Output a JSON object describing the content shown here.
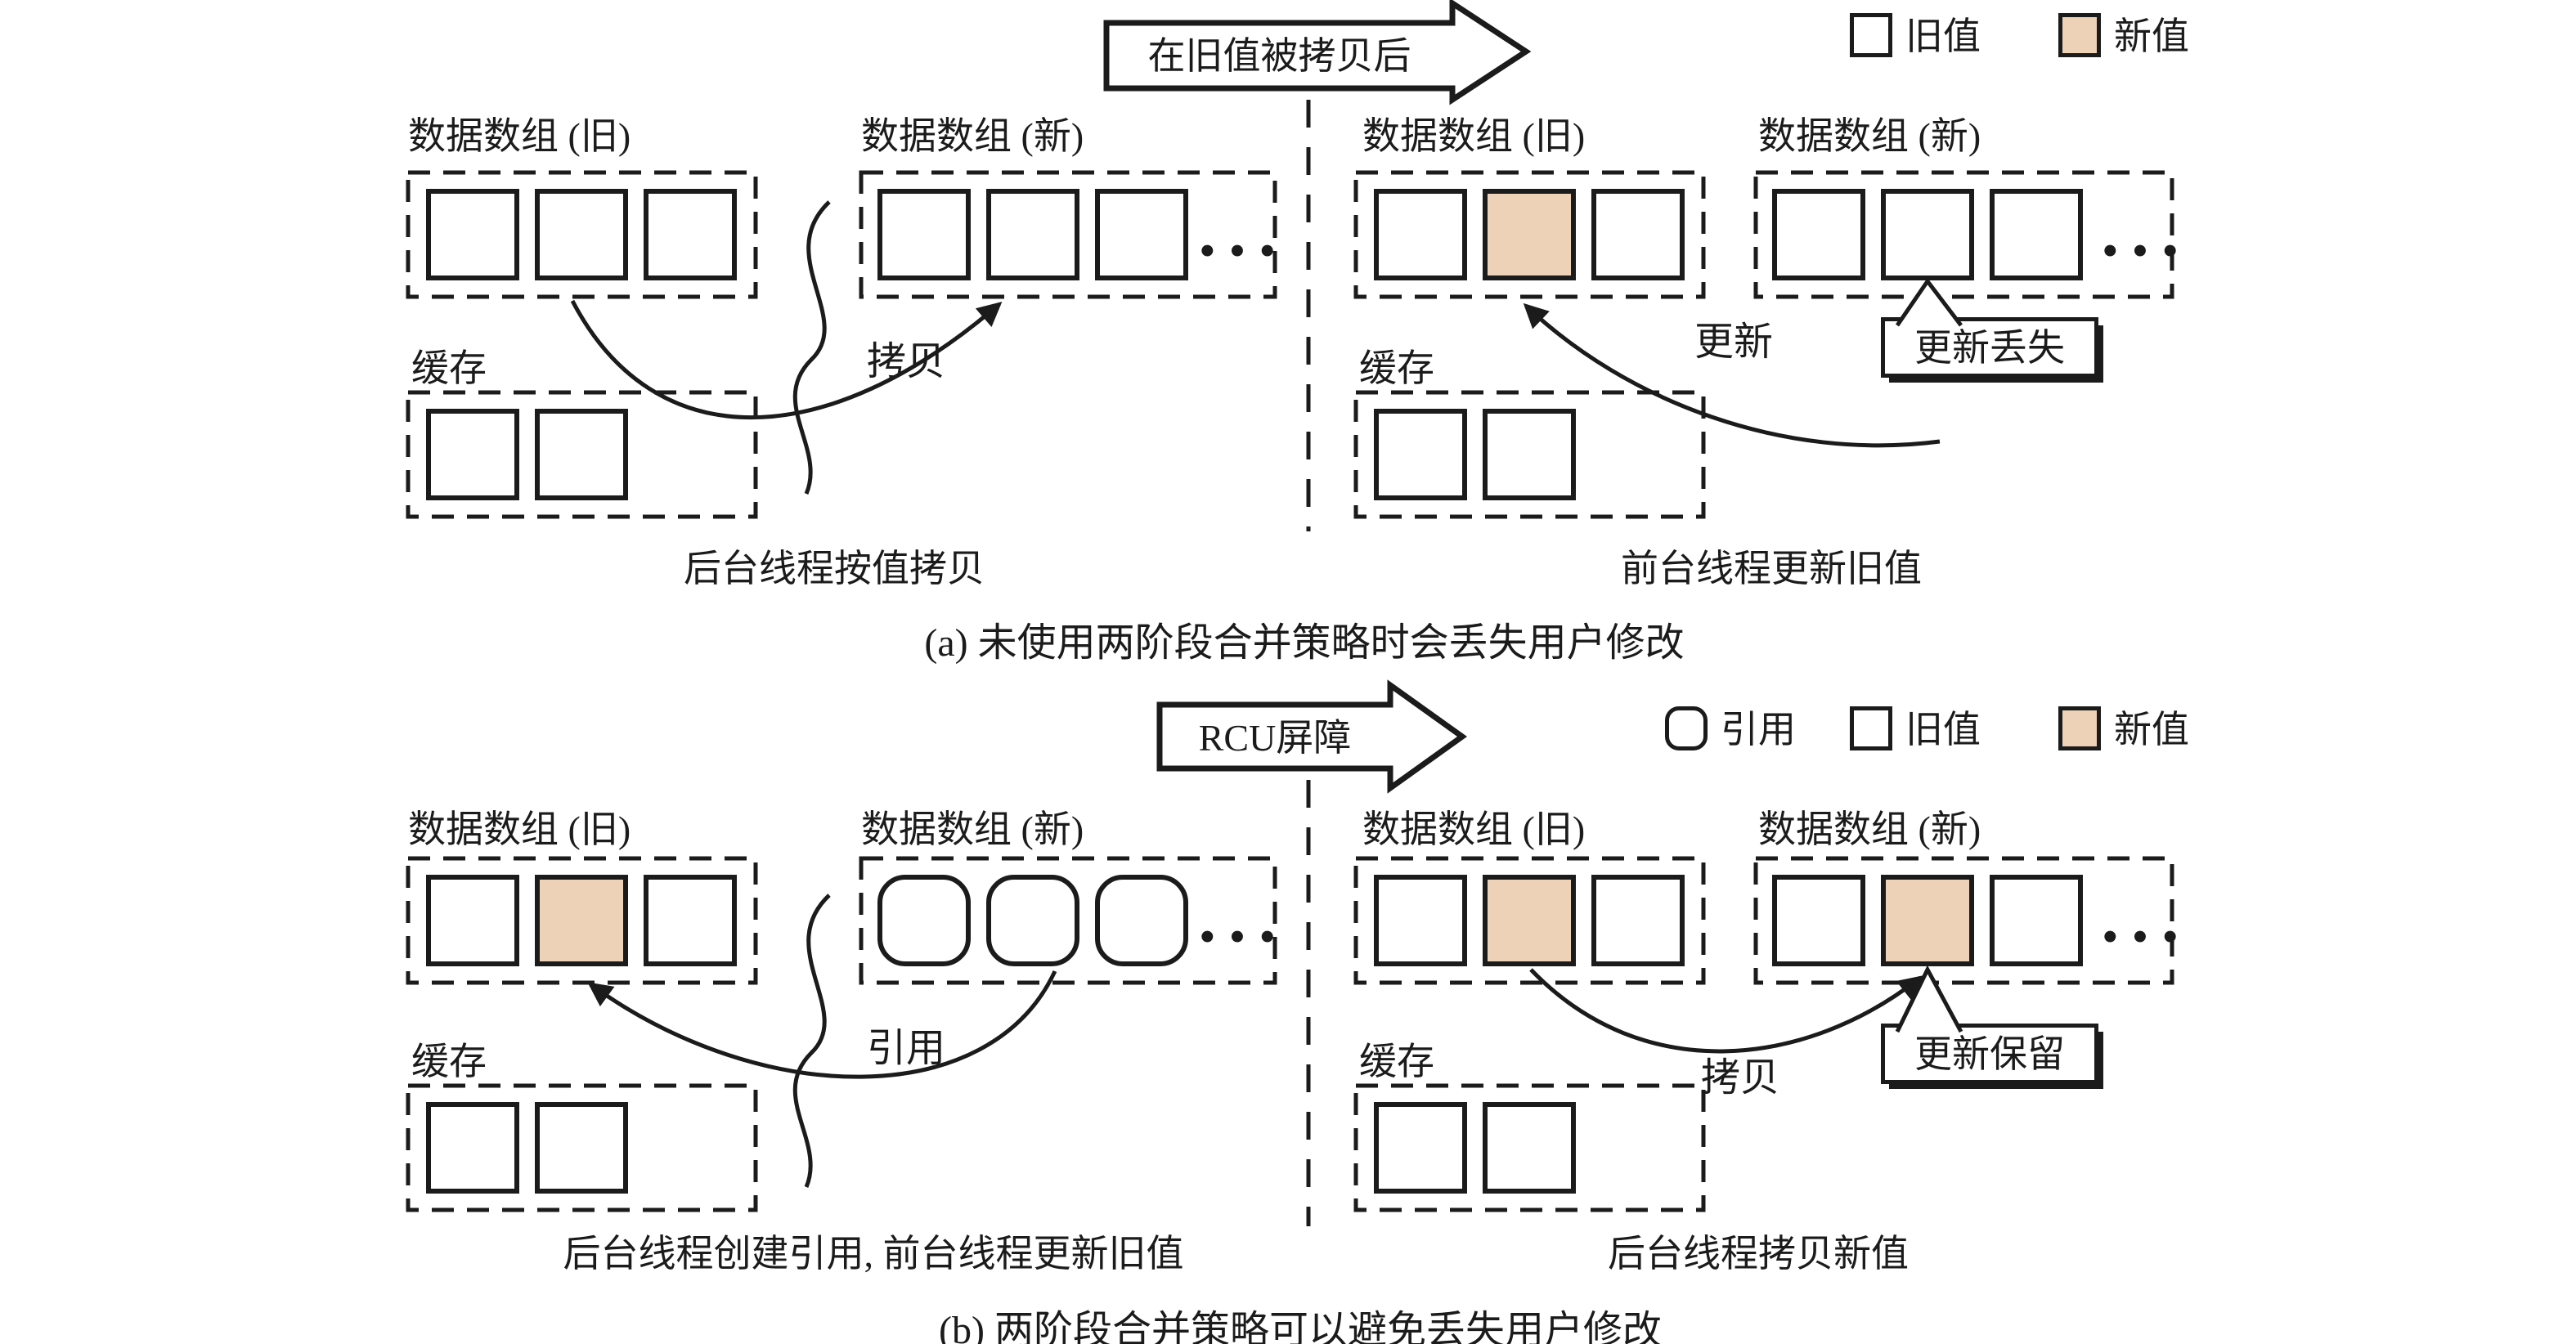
{
  "figure": {
    "accent_color": "#EED2B7",
    "ink_color": "#1b1b1b",
    "ellipsis": "···",
    "a": {
      "stage_arrow": "在旧值被拷贝后",
      "legend": {
        "old": "旧值",
        "new": "新值"
      },
      "left": {
        "old_title": "数据数组 (旧)",
        "new_title": "数据数组 (新)",
        "cache_title": "缓存",
        "flow_label": "拷贝",
        "caption": "后台线程按值拷贝",
        "old_cells": [
          "plain",
          "plain",
          "plain"
        ],
        "new_cells": [
          "plain",
          "plain",
          "plain"
        ],
        "cache_cells": [
          "plain",
          "plain"
        ]
      },
      "right": {
        "old_title": "数据数组 (旧)",
        "new_title": "数据数组 (新)",
        "cache_title": "缓存",
        "flow_label": "更新",
        "callout": "更新丢失",
        "caption": "前台线程更新旧值",
        "old_cells": [
          "plain",
          "new",
          "plain"
        ],
        "new_cells": [
          "plain",
          "plain",
          "plain"
        ],
        "cache_cells": [
          "plain",
          "plain"
        ]
      },
      "caption": "(a) 未使用两阶段合并策略时会丢失用户修改"
    },
    "b": {
      "stage_arrow": "RCU屏障",
      "legend": {
        "ref": "引用",
        "old": "旧值",
        "new": "新值"
      },
      "left": {
        "old_title": "数据数组 (旧)",
        "new_title": "数据数组 (新)",
        "cache_title": "缓存",
        "flow_label": "引用",
        "caption": "后台线程创建引用, 前台线程更新旧值",
        "old_cells": [
          "plain",
          "new",
          "plain"
        ],
        "new_cells": [
          "ref",
          "ref",
          "ref"
        ],
        "cache_cells": [
          "plain",
          "plain"
        ]
      },
      "right": {
        "old_title": "数据数组 (旧)",
        "new_title": "数据数组 (新)",
        "cache_title": "缓存",
        "flow_label": "拷贝",
        "callout": "更新保留",
        "caption": "后台线程拷贝新值",
        "old_cells": [
          "plain",
          "new",
          "plain"
        ],
        "new_cells": [
          "plain",
          "new",
          "plain"
        ],
        "cache_cells": [
          "plain",
          "plain"
        ]
      },
      "caption": "(b) 两阶段合并策略可以避免丢失用户修改"
    }
  }
}
